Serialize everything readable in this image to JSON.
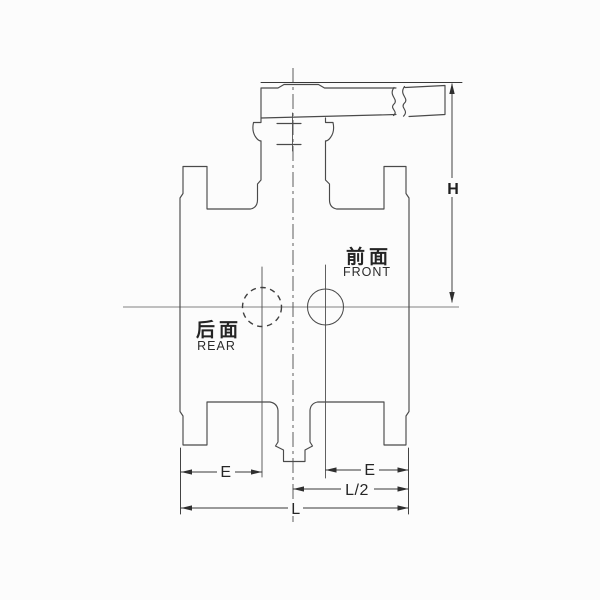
{
  "drawing": {
    "labels": {
      "front_cn": "前面",
      "front_en": "FRONT",
      "rear_cn": "后面",
      "rear_en": "REAR"
    },
    "dimensions": {
      "h": "H",
      "e_left": "E",
      "e_right": "E",
      "l_half": "L/2",
      "l": "L"
    },
    "colors": {
      "line": "#4a4a4a",
      "dimension": "#383838",
      "text": "#262626",
      "background": "#fcfcfc"
    }
  }
}
